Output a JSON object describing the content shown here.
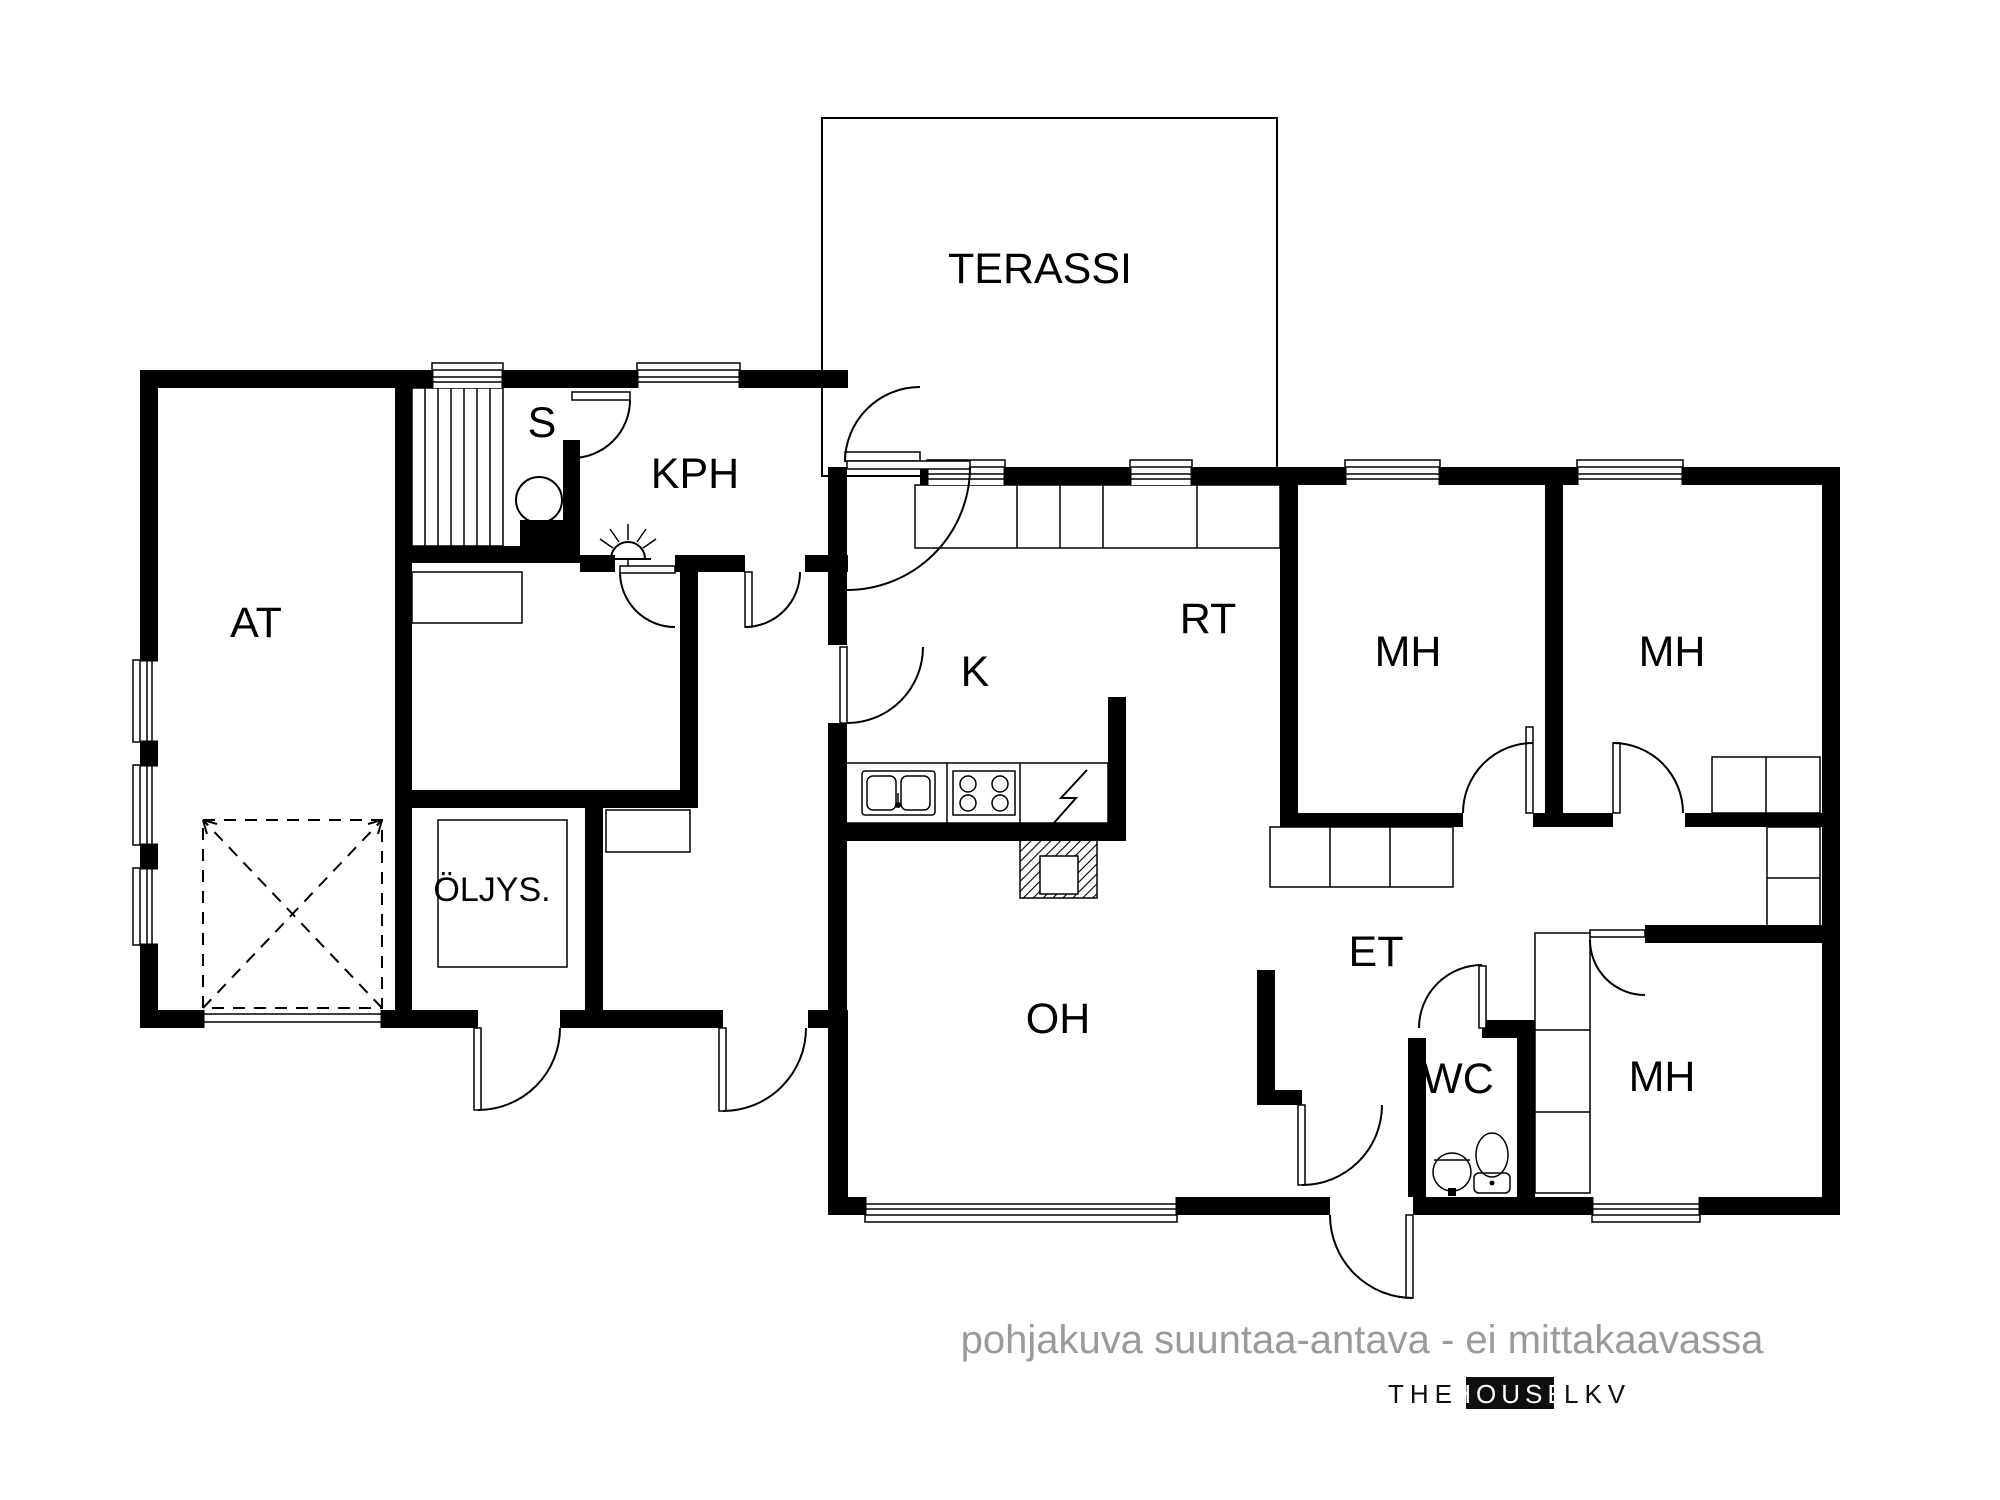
{
  "colors": {
    "wall": "#000000",
    "background": "#ffffff",
    "caption": "#9a9a9a",
    "logo": "#0f0f0f"
  },
  "rooms": {
    "terassi": {
      "label": "TERASSI"
    },
    "at": {
      "label": "AT"
    },
    "s": {
      "label": "S"
    },
    "kph": {
      "label": "KPH"
    },
    "k": {
      "label": "K"
    },
    "rt": {
      "label": "RT"
    },
    "mh_top_left": {
      "label": "MH"
    },
    "mh_top_right": {
      "label": "MH"
    },
    "mh_bottom": {
      "label": "MH"
    },
    "oljys": {
      "label": "ÖLJYS."
    },
    "oh": {
      "label": "OH"
    },
    "et": {
      "label": "ET"
    },
    "wc": {
      "label": "WC"
    }
  },
  "footer": {
    "caption": "pohjakuva suuntaa-antava - ei mittakaavassa"
  },
  "brand": {
    "the": "THE",
    "house": "HOUSE",
    "lkv": "LKV"
  }
}
